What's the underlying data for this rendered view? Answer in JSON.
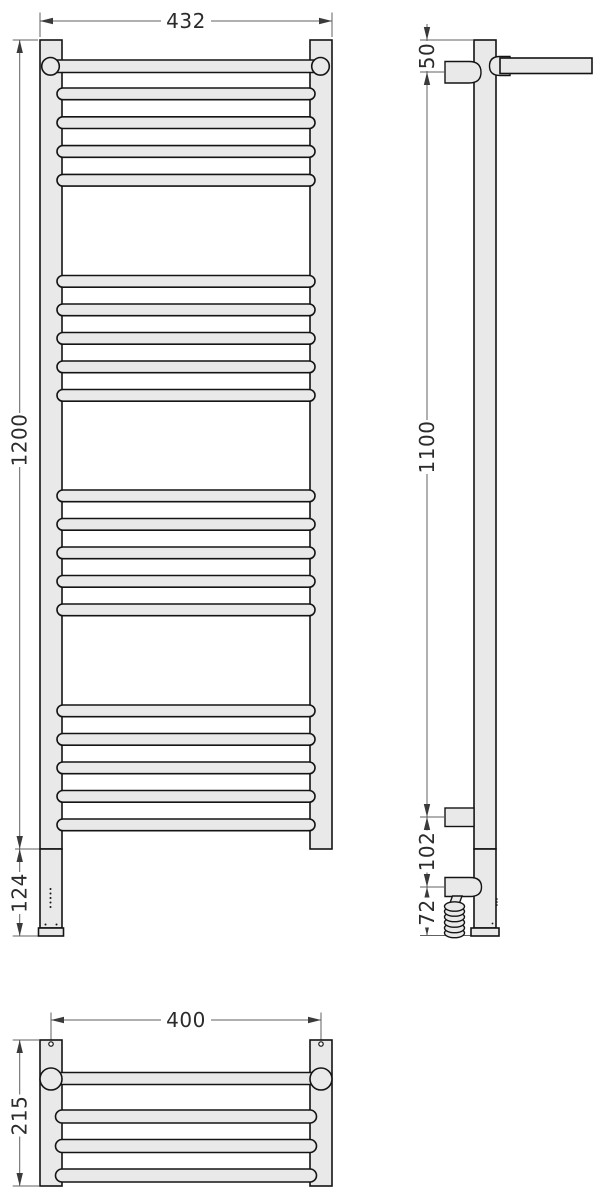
{
  "drawing": {
    "background": "#ffffff",
    "colors": {
      "outline": "#141414",
      "part_fill": "#e9e9e9",
      "dimension_line": "#606060",
      "label_text": "#2b2b2b"
    },
    "views": {
      "front": {
        "dims": {
          "width": "432",
          "height": "1200",
          "electric_section": "124"
        }
      },
      "side": {
        "dims": {
          "top_to_bracket": "50",
          "bracket_span": "1100",
          "bracket_to_gland": "102",
          "gland_to_bottom": "72"
        }
      },
      "plan": {
        "dims": {
          "mount_centers": "400",
          "depth": "215"
        }
      }
    }
  }
}
